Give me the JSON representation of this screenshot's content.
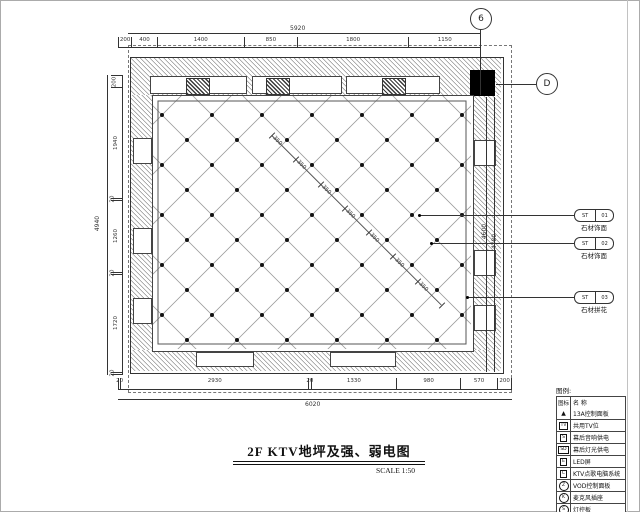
{
  "drawing": {
    "title": "2F KTV地坪及强、弱电图",
    "scale_label": "SCALE  1:50",
    "grid_bubbles": {
      "top": "6",
      "right": "D"
    }
  },
  "dimensions": {
    "top_overall": "5920",
    "top_segments": [
      "200",
      "400",
      "1400",
      "850",
      "1800",
      "1150"
    ],
    "left_overall": "4940",
    "left_segments": [
      "200",
      "1940",
      "20",
      "1260",
      "20",
      "1720",
      "20"
    ],
    "right_segments": [
      "4600",
      "4780"
    ],
    "bottom_segments": [
      "20",
      "2930",
      "20",
      "1330",
      "980",
      "570",
      "200"
    ],
    "bottom_overall": "6020",
    "diagonal_label": "350"
  },
  "callouts": [
    {
      "code": "ST-01",
      "label": "石材饰面"
    },
    {
      "code": "ST-02",
      "label": "石材饰面"
    },
    {
      "code": "ST-03",
      "label": "石材拼花"
    }
  ],
  "legend": {
    "title": "图例:",
    "col_symbol": "图标",
    "col_name": "名  称",
    "rows": [
      {
        "symbol": "▲",
        "shape": "triangle",
        "name": "13A控制面板"
      },
      {
        "symbol": "TV",
        "shape": "box",
        "name": "共用TV位"
      },
      {
        "symbol": "S",
        "shape": "box",
        "name": "幕后音响供电"
      },
      {
        "symbol": "SD",
        "shape": "box",
        "name": "幕后灯光供电"
      },
      {
        "symbol": "E",
        "shape": "box",
        "name": "LED屏"
      },
      {
        "symbol": "C",
        "shape": "box",
        "name": "KTV点歌电脑系统"
      },
      {
        "symbol": "Z",
        "shape": "circle",
        "name": "VOD控制面板"
      },
      {
        "symbol": "K",
        "shape": "circle",
        "name": "麦克风插座"
      },
      {
        "symbol": "S",
        "shape": "circle",
        "name": "灯控板"
      }
    ]
  }
}
